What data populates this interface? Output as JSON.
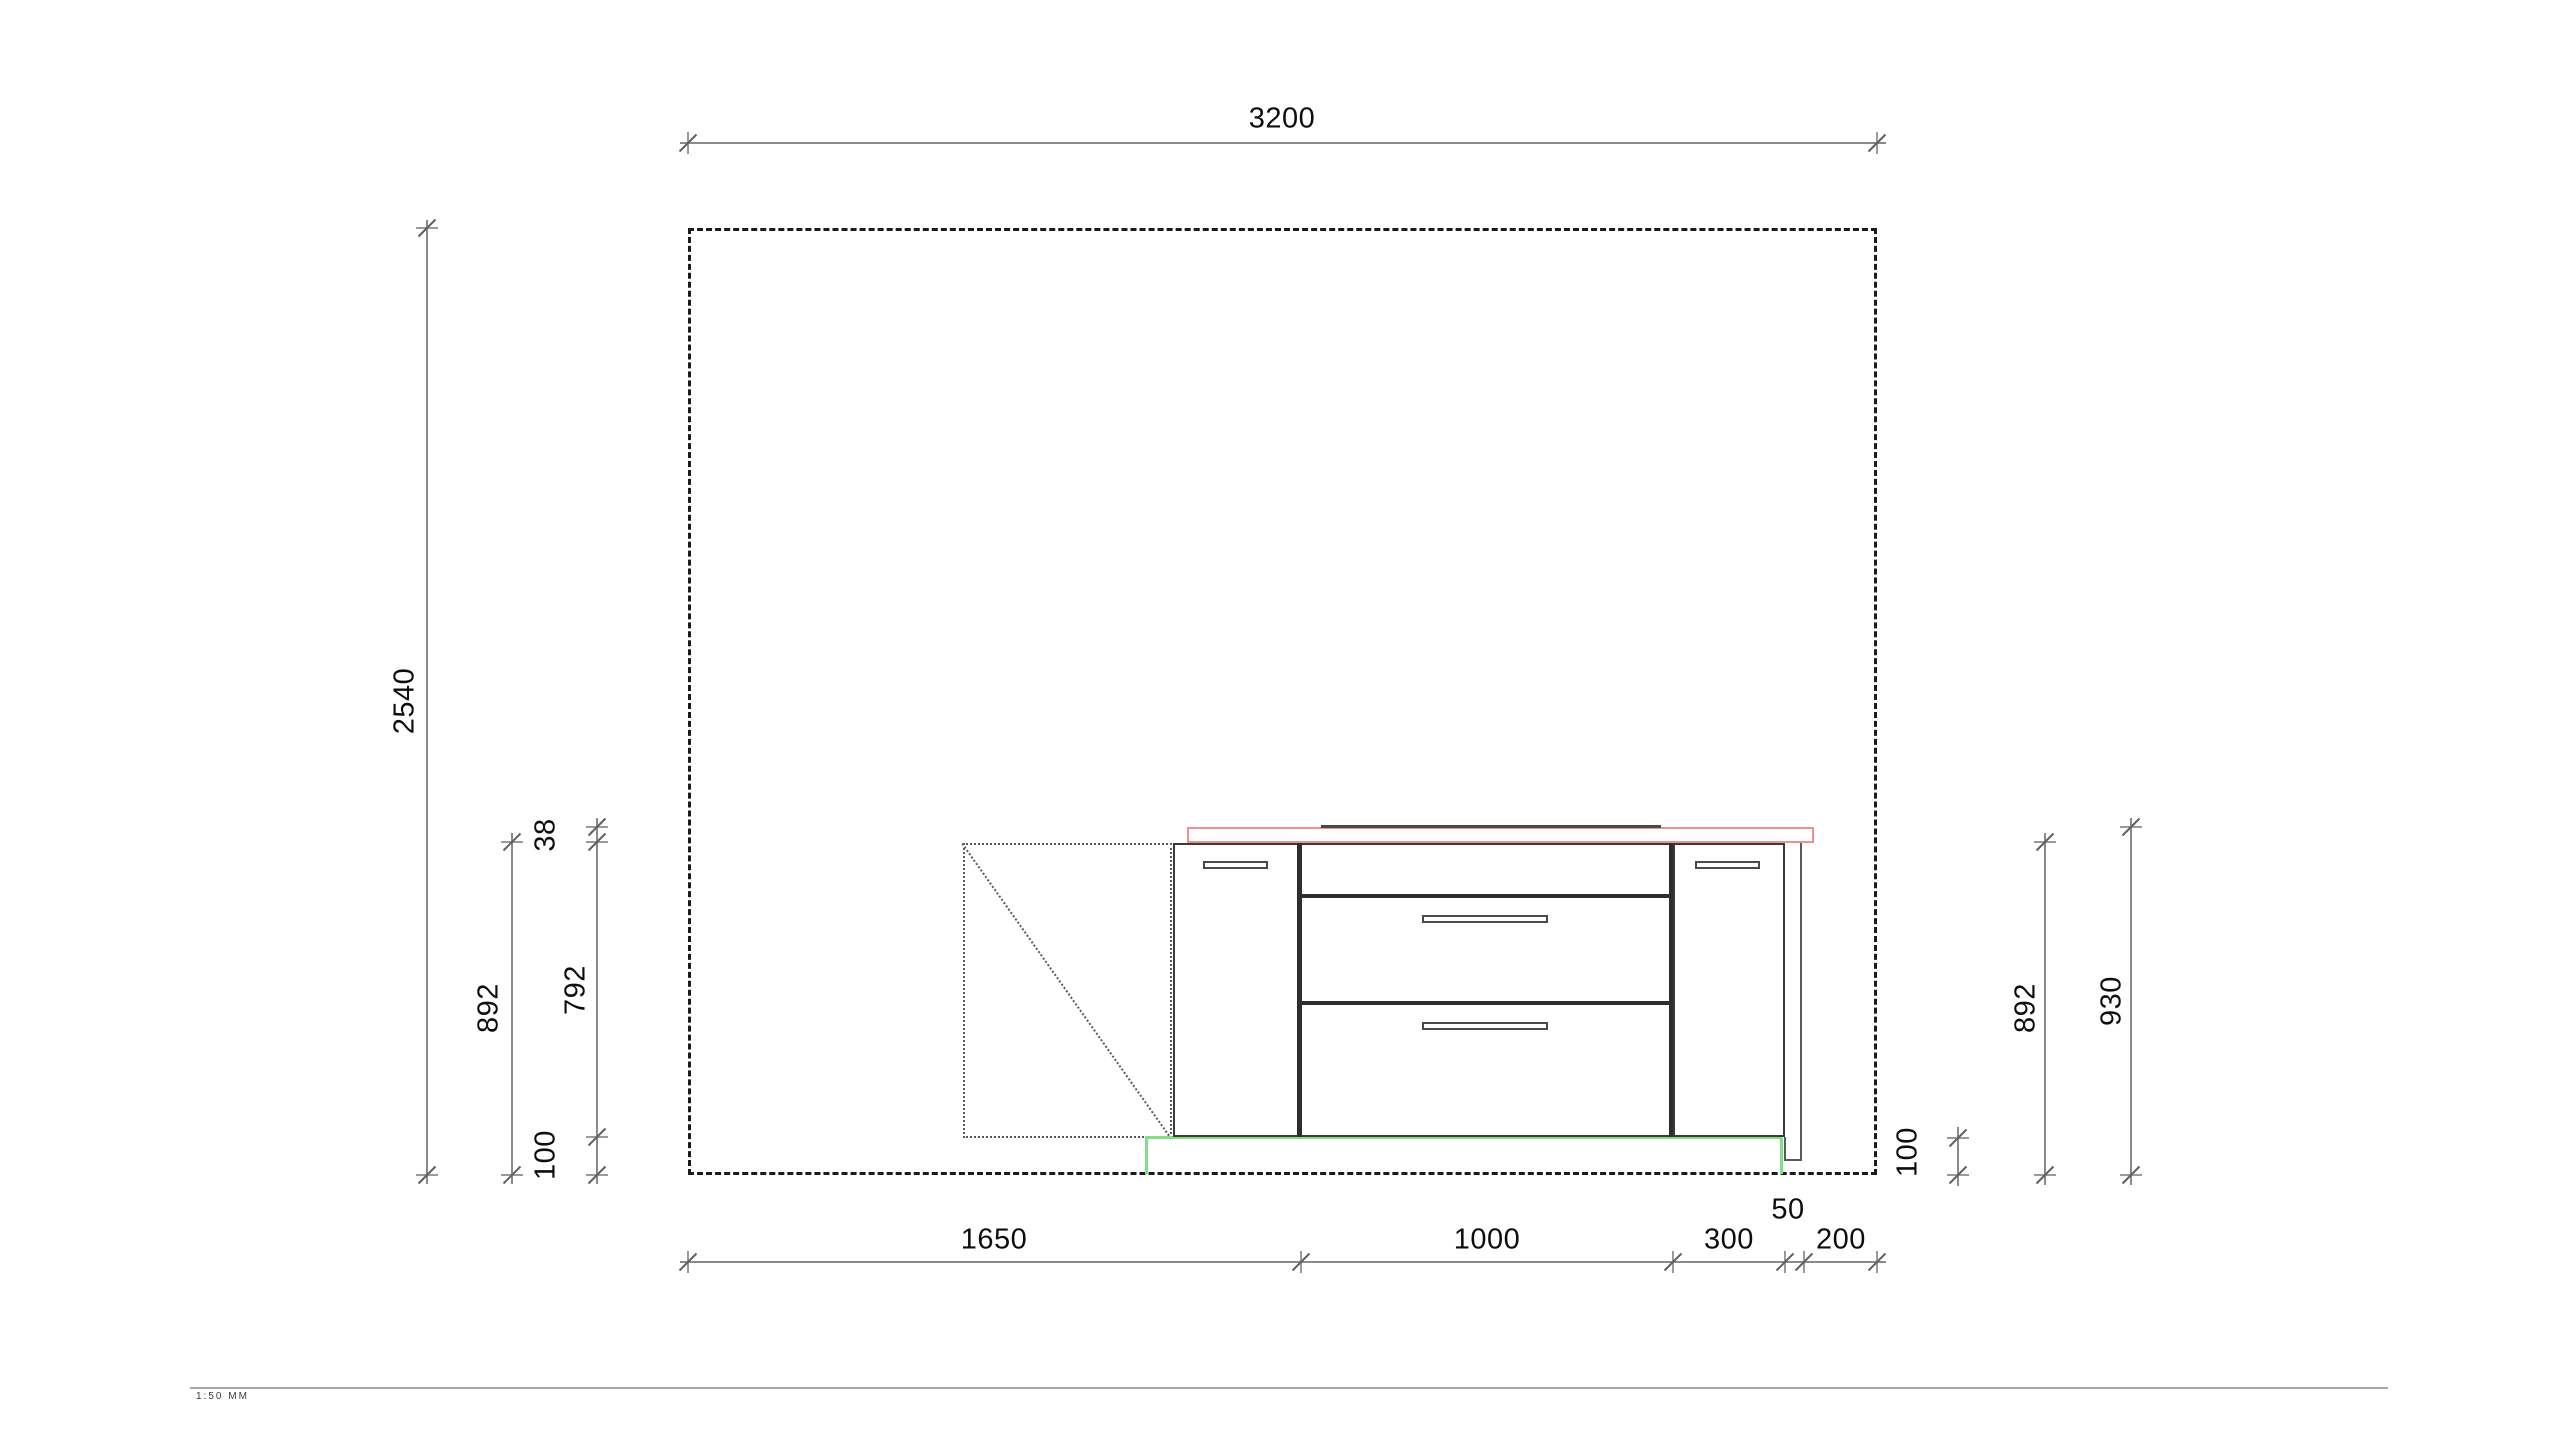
{
  "drawing": {
    "kind": "kitchen-elevation",
    "colors": {
      "wall_line": "#1b1b1b",
      "dimension_line": "#8a8a8a",
      "dimension_text": "#0d0d0d",
      "countertop_red": "#f0908e",
      "plinth_green": "#84de84"
    },
    "dimensions": {
      "wall_width": "3200",
      "wall_height": "2540",
      "left": {
        "worktop_thickness": "38",
        "carcass_height": "892",
        "front_height": "792",
        "plinth_height": "100"
      },
      "right": {
        "plinth_height": "100",
        "carcass_height": "892",
        "worktop_height": "930"
      },
      "bottom_run": [
        {
          "label": "1650"
        },
        {
          "label": "1000"
        },
        {
          "label": "300"
        },
        {
          "label": "50"
        },
        {
          "label": "200"
        }
      ]
    },
    "footer": {
      "scale_note": "1:50 MM"
    }
  }
}
